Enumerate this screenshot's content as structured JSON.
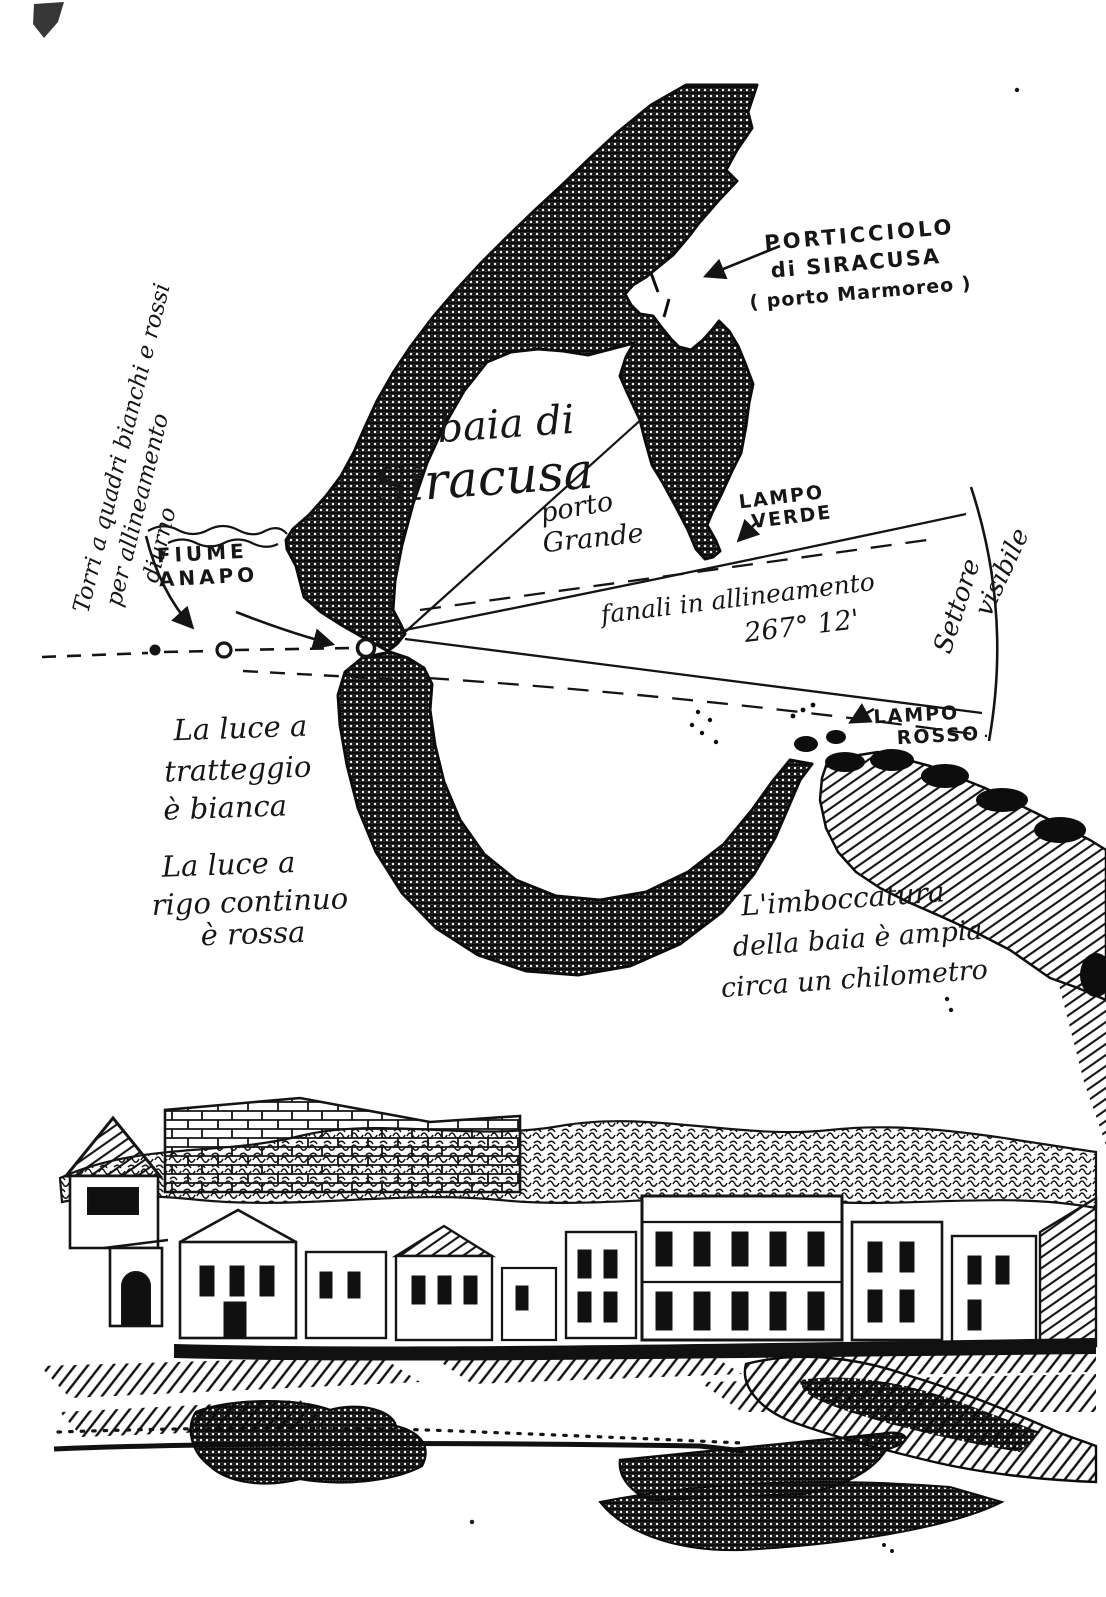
{
  "page": {
    "background": "#ffffff",
    "ink": "#161616",
    "width": 1106,
    "height": 1597
  },
  "map": {
    "title": {
      "lines": [
        "baia di",
        "Siracusa"
      ]
    },
    "bearing": "267° 12'",
    "labels": {
      "porticciolo": {
        "lines": [
          "PORTICCIOLO",
          "di SIRACUSA",
          "( porto Marmoreo )"
        ]
      },
      "porto_grande": {
        "lines": [
          "porto",
          "Grande"
        ]
      },
      "fiume_anapo": {
        "lines": [
          "FIUME",
          "ANAPO"
        ]
      },
      "lampo_verde": {
        "lines": [
          "LAMPO",
          "VERDE"
        ]
      },
      "lampo_rosso": {
        "lines": [
          "LAMPO",
          "ROSSO"
        ]
      },
      "fanali": {
        "lines": [
          "fanali in allineamento",
          "267° 12'"
        ]
      },
      "settore_visibile": {
        "lines": [
          "Settore",
          "visibile"
        ]
      },
      "torri": {
        "lines": [
          "Torri a quadri bianchi e rossi",
          "per allineamento",
          "diurno"
        ]
      },
      "luce_tratteggio": {
        "lines": [
          "La luce a",
          "tratteggio",
          "è bianca"
        ]
      },
      "luce_continua": {
        "lines": [
          "La luce a",
          "rigo continuo",
          "è rossa"
        ]
      },
      "imboccatura": {
        "lines": [
          "L'imboccatura",
          "della baia è ampia",
          "circa un chilometro"
        ]
      }
    },
    "symbols": {
      "daymark_dot": "filled-dot",
      "front_light": "circle-outline",
      "rear_light": "circle-outline",
      "white_light_sector": "dashed-line",
      "red_light_sector": "solid-line",
      "visible_sector_arc": "arc"
    }
  }
}
